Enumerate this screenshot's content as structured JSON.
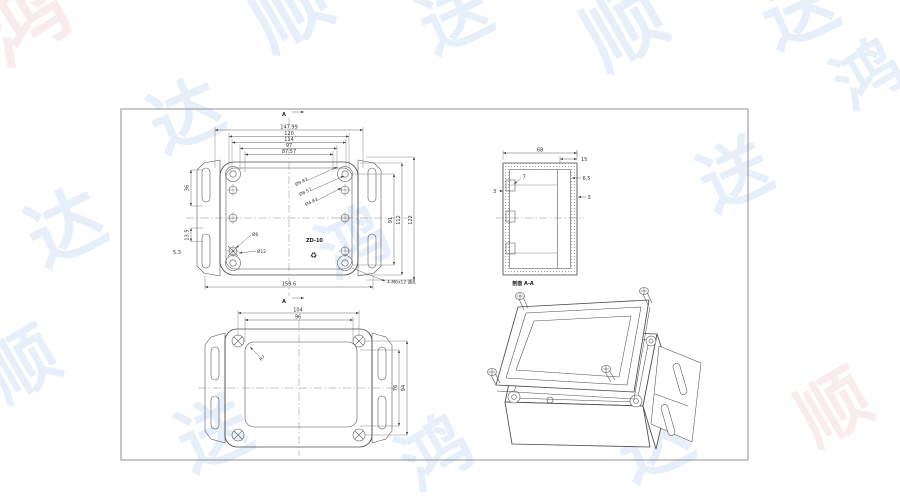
{
  "watermark": {
    "chars": [
      "鸿",
      "达",
      "顺",
      "送"
    ]
  },
  "top_view": {
    "section_label": "A",
    "dims_width_stack": [
      "147.99",
      "120",
      "114",
      "97",
      "87.57"
    ],
    "dim_bottom_width": "159.6",
    "dim_left_slot": "36",
    "dim_left_small": "13.5",
    "dim_left_offset": "5.3",
    "dims_height_stack": [
      "91",
      "112",
      "122"
    ],
    "leader_small_hole": "Ø6",
    "leader_large_hole": "Ø12",
    "leaders_corner_boss": [
      "Ø9.83",
      "Ø8.57",
      "Ø4.83"
    ],
    "leader_mounting_holes": "4-M6x12 通孔",
    "part_marking": "ZD-10",
    "recycle_mark": "♻"
  },
  "section_view": {
    "dim_width": "68",
    "dim_lid_lip": "15",
    "dim_rib": "6.5",
    "dim_wall_right": "3",
    "dim_clip_width": "7",
    "dim_wall_left": "3",
    "caption": "剖面 A-A"
  },
  "bottom_view": {
    "dim_screw_spacing": "104",
    "dim_inner_width": "96",
    "dim_inner_height": "76",
    "dim_screw_spacing_v": "94",
    "leader_corner_radius": "R7"
  }
}
